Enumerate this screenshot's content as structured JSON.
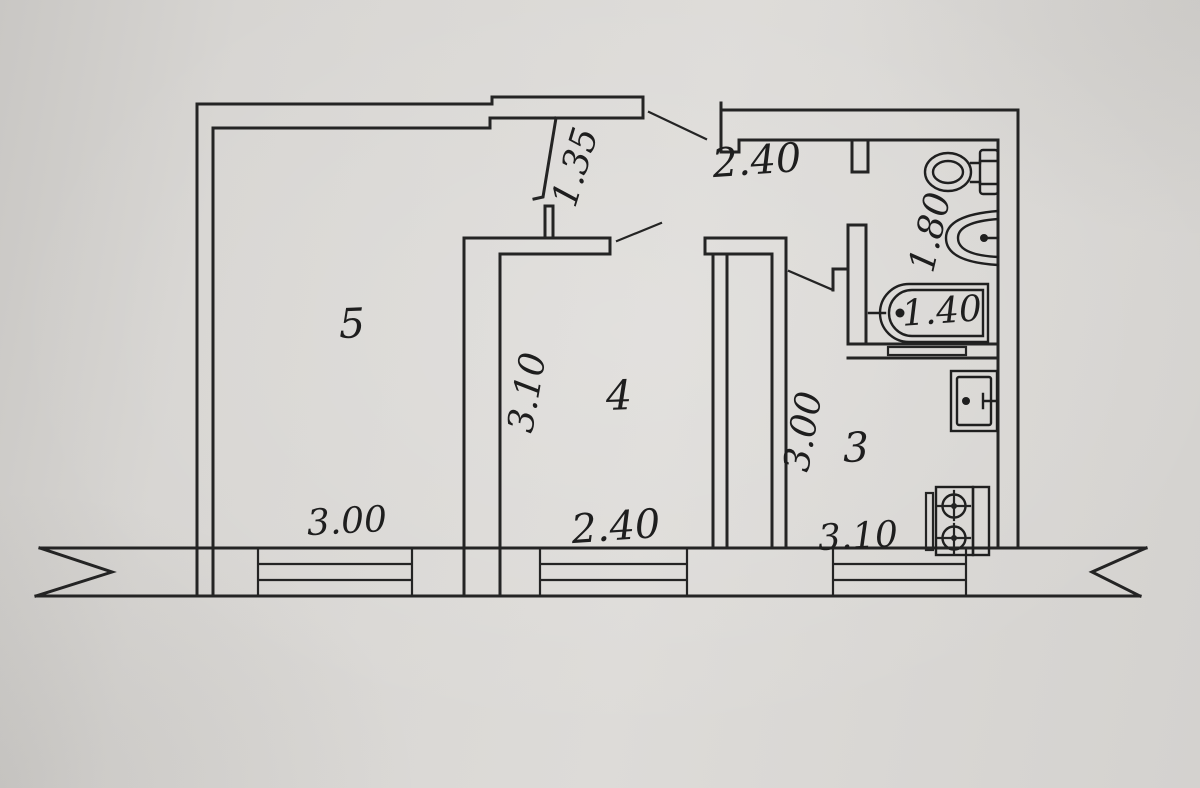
{
  "palette": {
    "background": "#d7d5d2",
    "ink": "#242424"
  },
  "plan": {
    "rooms": [
      {
        "number": "5",
        "width_label": "3.00"
      },
      {
        "number": "4",
        "depth_label": "3.10",
        "width_label": "2.40"
      },
      {
        "number": "3",
        "depth_label": "3.00",
        "width_label": "3.10"
      }
    ],
    "corridor": {
      "width_label": "1.35"
    },
    "hallway": {
      "width_label": "2.40"
    },
    "bathroom": {
      "depth_label": "1.80",
      "bathtub_label": "1.40"
    },
    "fixtures": [
      "toilet",
      "washbasin",
      "bathtub",
      "kitchen sink",
      "stove"
    ]
  }
}
